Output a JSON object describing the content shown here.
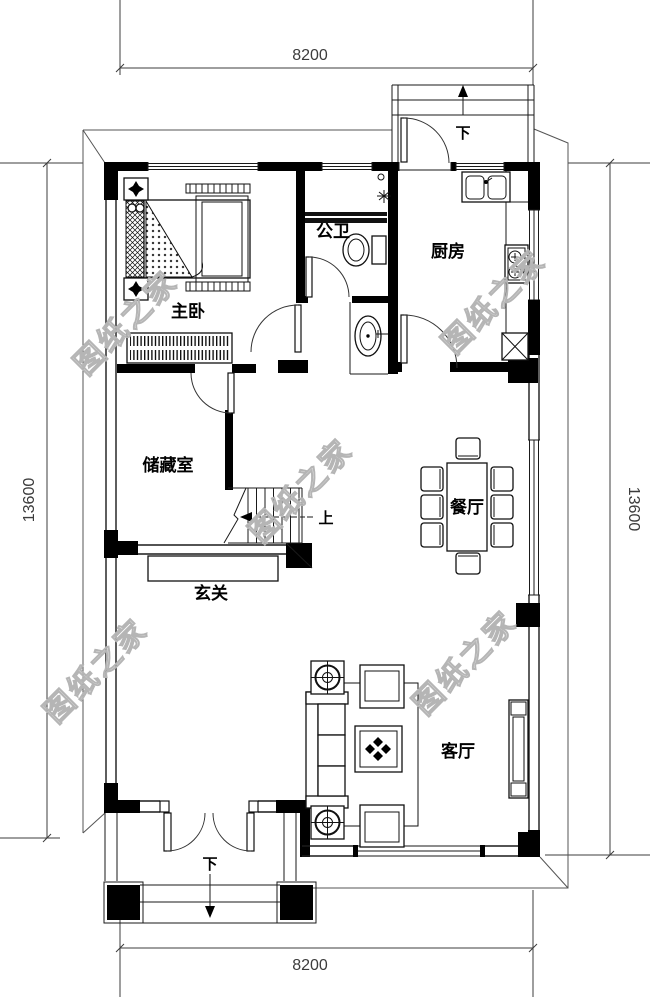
{
  "title": "residential-floor-plan",
  "watermark_text": "图纸之家",
  "dimensions": {
    "top": "8200",
    "bottom": "8200",
    "left": "13600",
    "right": "13600"
  },
  "rooms": {
    "master_bedroom": {
      "label": "主卧"
    },
    "bathroom": {
      "label": "公卫"
    },
    "kitchen": {
      "label": "厨房"
    },
    "storage": {
      "label": "储藏室"
    },
    "dining": {
      "label": "餐厅"
    },
    "foyer": {
      "label": "玄关"
    },
    "living": {
      "label": "客厅"
    }
  },
  "stairs": {
    "up_label": "上"
  },
  "entrances": {
    "back_step_label": "下",
    "front_step_label": "下"
  },
  "colors": {
    "wall": "#000000",
    "line": "#1a1a1a",
    "watermark": "#b5b5b5",
    "dim_text": "#3c3c3c",
    "background": "#ffffff"
  }
}
